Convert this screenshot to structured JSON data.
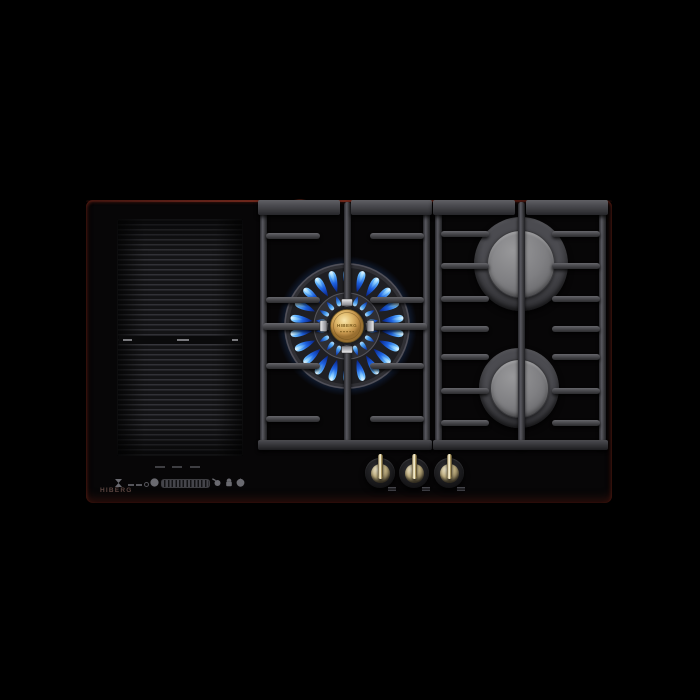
{
  "brand": {
    "logo": "HIBERG"
  },
  "burner_center": {
    "cap_text": "HIBERG",
    "state": "lit",
    "outer_flames": 22,
    "inner_flames": 18
  },
  "right_burners": [
    {
      "position": "top",
      "size": "large",
      "state": "off"
    },
    {
      "position": "bottom",
      "size": "medium",
      "state": "off"
    }
  ],
  "induction_zone": {
    "type": "flex",
    "segments": 2,
    "divider_ticks": 3
  },
  "control_panel": {
    "icons": [
      "timer-icon",
      "display-dashes",
      "degree-dot",
      "keep-warm-icon",
      "power-slider",
      "pan-detection-icon",
      "lock-icon",
      "power-icon"
    ],
    "slider_segments": 13,
    "position_ticks": 3
  },
  "knobs": {
    "count": 3
  },
  "colors": {
    "background": "#000000",
    "glass": "#070607",
    "edge_maroon": "#6b241a",
    "grate_gray": "#4a4a4e",
    "burner_cap_gold": "#d9b665",
    "right_cap_gray": "#7f7f82",
    "flame_blue": "#1e62e0",
    "flame_cyan": "#9fe2ff",
    "flame_tip": "#0a2a8c",
    "logo_color": "#5c4540"
  }
}
